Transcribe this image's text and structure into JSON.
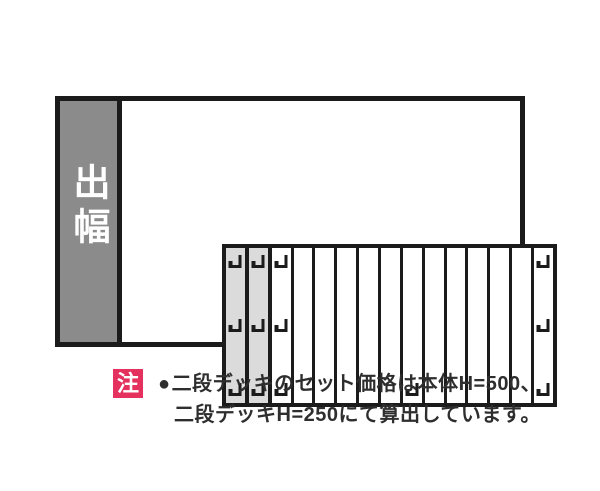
{
  "diagram": {
    "depth_label": "出幅",
    "deck": {
      "slat_count": 15,
      "gray_slat_indexes": [
        1,
        2
      ],
      "clip_rows": {
        "top": [
          1,
          2,
          3,
          15
        ],
        "middle": [
          1,
          2,
          3,
          15
        ],
        "bottom": [
          1,
          2,
          3,
          9,
          15
        ]
      }
    },
    "colors": {
      "line": "#1b1b1b",
      "depth_bar_bg": "#8b8b8b",
      "depth_label_color": "#ffffff",
      "gray_slat_bg": "#dbdbdb",
      "slat_bg": "#ffffff",
      "note_badge_bg": "#e5315d",
      "note_badge_color": "#ffffff",
      "note_text_color": "#2e2e2e"
    }
  },
  "note": {
    "badge_label": "注",
    "bullet": "●",
    "line1": "二段デッキのセット価格は本体H=500、",
    "line2": "二段デッキH=250にて算出しています。"
  }
}
